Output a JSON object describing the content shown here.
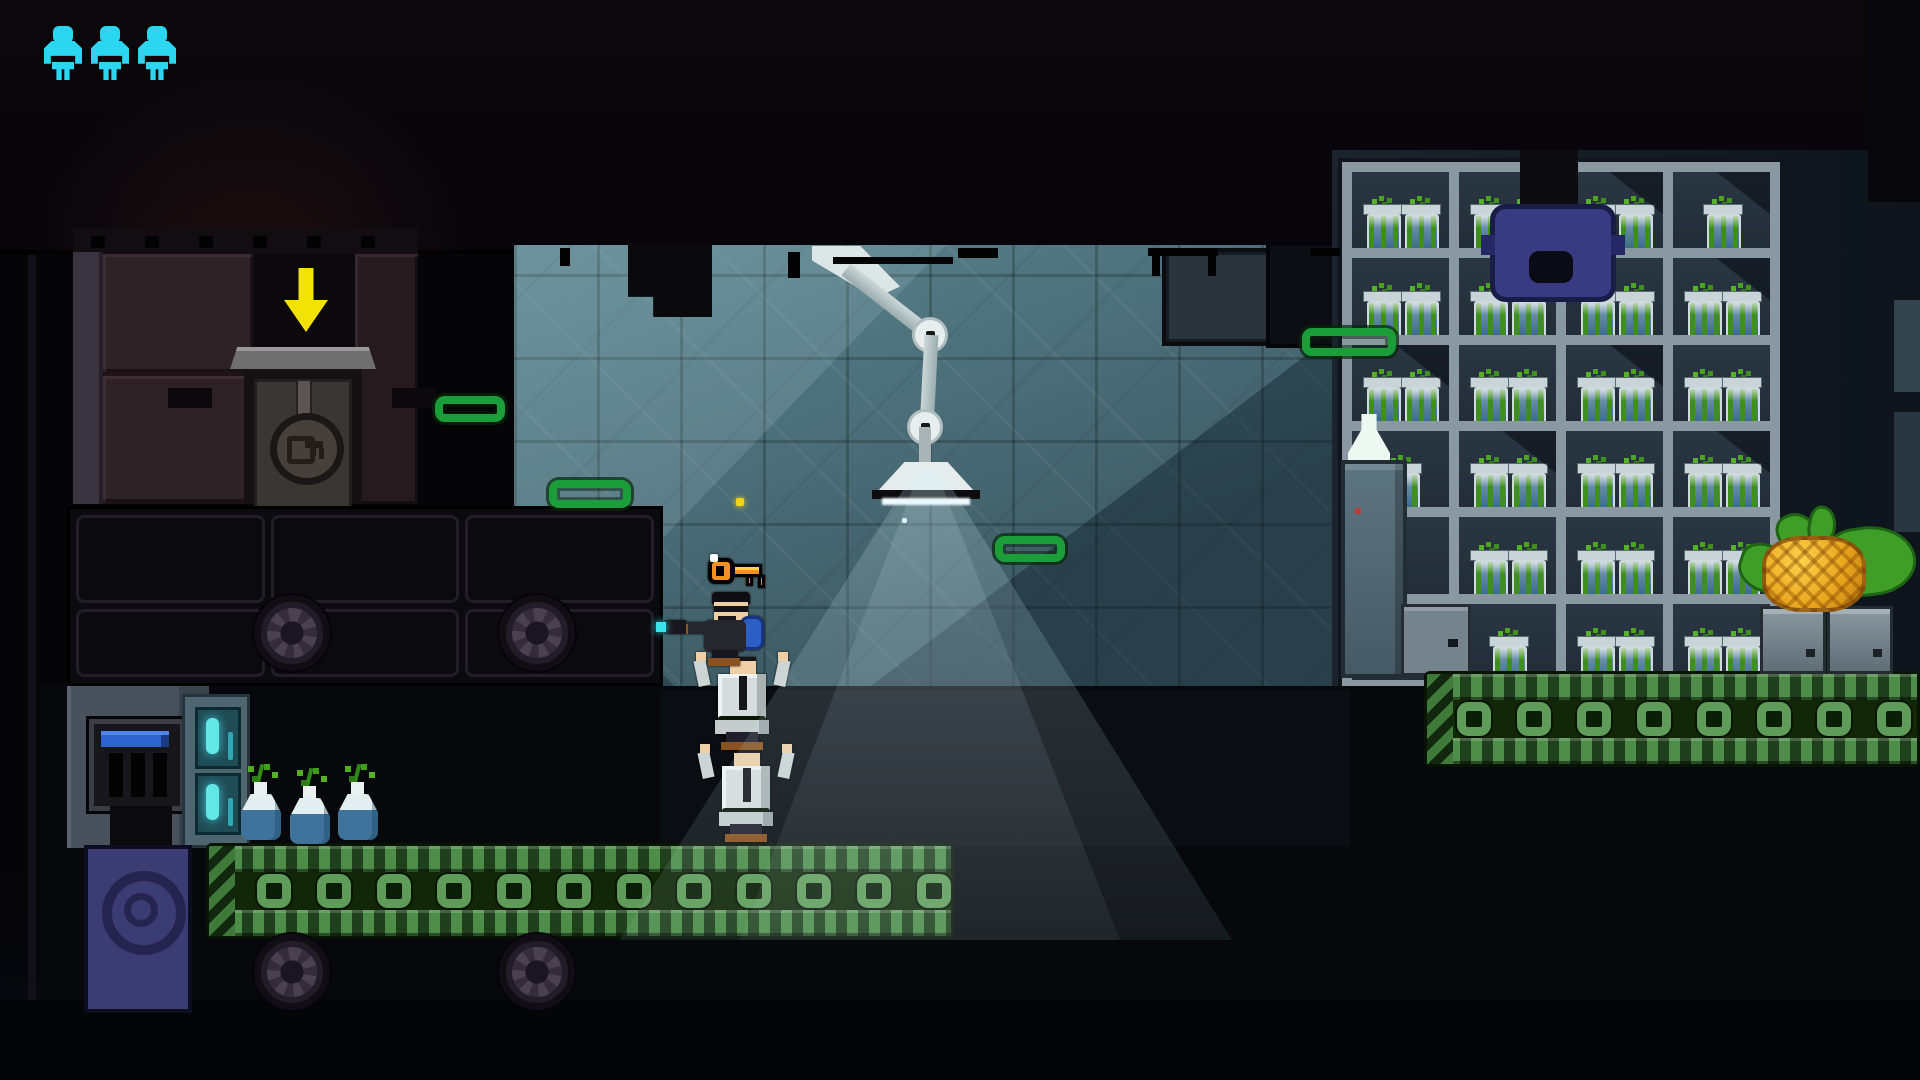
{
  "hud": {
    "lives_count": 3,
    "lives_icon": "person-icon",
    "lives_color": "#2bd7f0"
  },
  "scene": {
    "exit_door": {
      "arrow_icon": "down-arrow-icon",
      "arrow_color": "#f2e206",
      "emblem_icon": "key-icon",
      "state": "locked"
    },
    "collectible_key": {
      "icon": "key-icon",
      "body_color": "#f29020",
      "highlight_color": "#ffd24a"
    },
    "characters": [
      {
        "role": "player",
        "holding": "stun-gun",
        "carrying": "key",
        "position": "top-of-stack"
      },
      {
        "role": "scientist",
        "position": "middle-of-stack"
      },
      {
        "role": "scientist",
        "position": "bottom-of-stack"
      }
    ],
    "lamp": {
      "type": "articulated-robot-lamp",
      "state": "on"
    },
    "belts": {
      "left": {
        "rings": 12
      },
      "right": {
        "rings": 8
      }
    },
    "belt_flasks": 3,
    "shelf": {
      "rows": 6,
      "cols": 4,
      "jars": [
        [
          2,
          2,
          2,
          1
        ],
        [
          2,
          2,
          2,
          2
        ],
        [
          2,
          2,
          2,
          2
        ],
        [
          1,
          2,
          2,
          2
        ],
        [
          0,
          2,
          2,
          2
        ],
        [
          0,
          1,
          2,
          2
        ]
      ],
      "shade": [
        [
          0,
          0,
          1,
          1
        ],
        [
          0,
          0,
          0,
          1
        ],
        [
          1,
          0,
          1,
          0
        ],
        [
          0,
          1,
          0,
          1
        ],
        [
          0,
          0,
          0,
          0
        ],
        [
          0,
          0,
          0,
          0
        ]
      ]
    },
    "pipes": [
      [
        435,
        396,
        70,
        26
      ],
      [
        549,
        480,
        82,
        28
      ],
      [
        995,
        536,
        70,
        26
      ],
      [
        1302,
        328,
        94,
        28
      ]
    ],
    "ceiling_tabs": [
      [
        560,
        248,
        10,
        18
      ],
      [
        788,
        252,
        12,
        26
      ],
      [
        833,
        257,
        120,
        7
      ],
      [
        958,
        248,
        40,
        10
      ],
      [
        1148,
        248,
        70,
        8
      ],
      [
        1152,
        252,
        8,
        24
      ],
      [
        1208,
        252,
        8,
        24
      ],
      [
        1310,
        248,
        30,
        8
      ]
    ],
    "room_tabs": [
      18,
      72,
      126,
      180,
      234,
      288
    ],
    "fruit": {
      "name": "pineapple"
    }
  },
  "palette": {
    "cyan": "#2bd7f0",
    "arrow": "#f2e206",
    "wall_lit": "#5d8791",
    "wall_dark": "#3e5c66",
    "belt_green": "#4e8c49",
    "ring_green": "#5f9c59",
    "pipe_green": "#1b9e3a",
    "key_orange": "#f29020",
    "backpack_blue": "#2b5fc6",
    "gun_cyan": "#3ae2ea",
    "machine_purple": "#383b82",
    "room_maroon": "#2e2227"
  }
}
